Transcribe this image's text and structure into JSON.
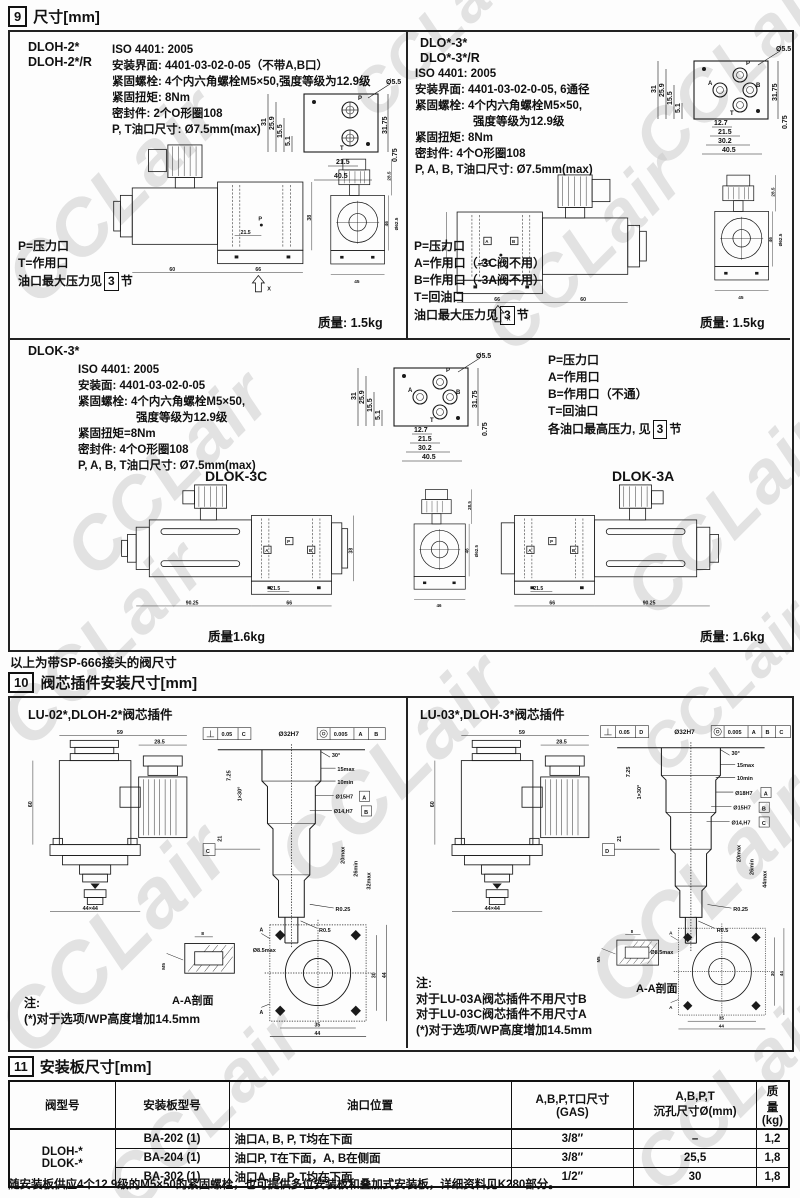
{
  "watermark": {
    "text": "CCLair"
  },
  "sec9": {
    "num": "9",
    "title": "尺寸[mm]",
    "dloh2": {
      "models": [
        "DLOH-2*",
        "DLOH-2*/R"
      ],
      "specs": [
        "ISO 4401: 2005",
        "安装界面: 4401-03-02-0-05（不带A,B口）",
        "紧固螺栓: 4个内六角螺栓M5×50,强度等级为12.9级",
        "紧固扭矩: 8Nm",
        "密封件: 2个O形圈108",
        "P, T油口尺寸: Ø7.5mm(max)"
      ],
      "ports": [
        "P=压力口",
        "T=作用口"
      ],
      "pnote": {
        "prefix": "油口最大压力见",
        "ref": "3",
        "suffix": "节"
      },
      "mass": "质量: 1.5kg",
      "face": {
        "callout": "Ø5.5",
        "p": "P",
        "t": "T",
        "l1": "31",
        "l2": "25.9",
        "l3": "15.5",
        "l4": "5.1",
        "b1": "21.5",
        "b2": "40.5",
        "r1": "31.75",
        "r2": "0.75"
      },
      "side": {
        "d1": "60",
        "d2": "66",
        "d3": "21.5",
        "d4": "38",
        "p": "P",
        "x": "X"
      },
      "end": {
        "d1": "28.5",
        "d2": "Ø62.5",
        "d3": "46",
        "d4": "45"
      }
    },
    "dlo3": {
      "models": [
        "DLO*-3*",
        "DLO*-3*/R"
      ],
      "specs": [
        "ISO 4401: 2005",
        "安装界面: 4401-03-02-0-05, 6通径",
        "紧固螺栓: 4个内六角螺栓M5×50,",
        "强度等级为12.9级",
        "紧固扭矩: 8Nm",
        "密封件: 4个O形圈108",
        "P, A, B, T油口尺寸: Ø7.5mm(max)"
      ],
      "ports": [
        "P=压力口",
        "A=作用口（-3C阀不用）",
        "B=作用口（-3A阀不用）",
        "T=回油口"
      ],
      "pnote": {
        "prefix": "油口最大压力见",
        "ref": "3",
        "suffix": "节"
      },
      "mass": "质量: 1.5kg",
      "face": {
        "callout": "Ø5.5",
        "p": "P",
        "a": "A",
        "b": "B",
        "t": "T",
        "l1": "31",
        "l2": "25.9",
        "l3": "15.5",
        "l4": "5.1",
        "b0": "12.7",
        "b1": "21.5",
        "b15": "30.2",
        "b2": "40.5",
        "r1": "31.75",
        "r2": "0.75"
      },
      "side": {
        "d1": "66",
        "d2": "60",
        "d3": "21.5",
        "d4": "38",
        "a": "A",
        "b": "B",
        "x": "X"
      },
      "end": {
        "d1": "28.5",
        "d2": "Ø62.5",
        "d3": "46",
        "d4": "45"
      }
    },
    "dlok3": {
      "model": "DLOK-3*",
      "specs": [
        "ISO 4401: 2005",
        "安装面: 4401-03-02-0-05",
        "紧固螺栓: 4个内六角螺栓M5×50,",
        "强度等级为12.9级",
        "紧固扭矩=8Nm",
        "密封件: 4个O形圈108",
        "P, A, B, T油口尺寸: Ø7.5mm(max)"
      ],
      "ports": [
        "P=压力口",
        "A=作用口",
        "B=作用口（不通）",
        "T=回油口"
      ],
      "pnote": {
        "prefix": "各油口最高压力, 见",
        "ref": "3",
        "suffix": "节"
      },
      "face": {
        "callout": "Ø5.5",
        "p": "P",
        "a": "A",
        "b": "B",
        "t": "T",
        "l1": "31",
        "l2": "25.9",
        "l3": "15.5",
        "l4": "5.1",
        "b0": "12.7",
        "b1": "21.5",
        "b15": "30.2",
        "b2": "40.5",
        "r1": "31.75",
        "r2": "0.75"
      },
      "c": {
        "title": "DLOK-3C",
        "mass": "质量1.6kg",
        "d1": "90.25",
        "d2": "66",
        "d3": "21.5",
        "d4": "38",
        "a": "A",
        "p": "P",
        "b": "B"
      },
      "a": {
        "title": "DLOK-3A",
        "mass": "质量: 1.6kg",
        "d1": "66",
        "d2": "90.25",
        "d3": "21.5",
        "a": "A",
        "p": "P",
        "b": "B"
      },
      "end": {
        "d1": "28.5",
        "d2": "Ø62.5",
        "d3": "46",
        "d4": "46"
      }
    },
    "sp_note": "以上为带SP-666接头的阀尺寸"
  },
  "sec10": {
    "num": "10",
    "title": "阀芯插件安装尺寸[mm]",
    "left": {
      "title": "LU-02*,DLOH-2*阀芯插件",
      "cart": {
        "d1": "59",
        "d2": "28.5",
        "d3": "60",
        "d4": "44×44"
      },
      "cavity": {
        "f1": "0.05",
        "f1d": "C",
        "bore": "Ø32H7",
        "f2": "0.005",
        "f2a": "A",
        "f2b": "B",
        "ang": "30°",
        "r1": "15max",
        "r2": "10min",
        "h1": "Ø15H7",
        "h1d": "A",
        "h2": "Ø14,H7",
        "h2d": "B",
        "l1": "7.25",
        "l2": "1×30°",
        "l3": "21",
        "s1": "20max",
        "s2": "26min",
        "s3": "32max",
        "rr1": "R0.25",
        "rr2": "R0.5",
        "bot": "Ø8.5max",
        "datum": "C"
      },
      "aa": {
        "w": "8",
        "m": "M5",
        "label": "A-A剖面"
      },
      "flange": {
        "a": "A",
        "r1": "30",
        "r2": "44",
        "b1": "35",
        "b2": "44"
      },
      "notes": [
        "注:",
        "(*)对于选项/WP高度增加14.5mm"
      ]
    },
    "right": {
      "title": "LU-03*,DLOH-3*阀芯插件",
      "cart": {
        "d1": "59",
        "d2": "28.5",
        "d3": "60",
        "d4": "44×44"
      },
      "cavity": {
        "f1": "0.05",
        "f1d": "D",
        "bore": "Ø32H7",
        "f2": "0.005",
        "f2a": "A",
        "f2b": "B",
        "f2c": "C",
        "ang": "30°",
        "r1": "15max",
        "r2": "10min",
        "h0": "Ø18H7",
        "h0d": "A",
        "h1": "Ø15H7",
        "h1d": "B",
        "h2": "Ø14,H7",
        "h2d": "C",
        "l1": "7.25",
        "l2": "1×30°",
        "l3": "21",
        "s1": "20max",
        "s2": "26min",
        "s3": "44max",
        "rr1": "R0.25",
        "rr2": "R0.5",
        "bot": "Ø8.5max",
        "datum": "D"
      },
      "aa": {
        "w": "8",
        "m": "M5",
        "label": "A-A剖面"
      },
      "flange": {
        "a": "A",
        "r1": "30",
        "r2": "44",
        "b1": "35",
        "b2": "44"
      },
      "notes": [
        "注:",
        "对于LU-03A阀芯插件不用尺寸B",
        "对于LU-03C阀芯插件不用尺寸A",
        "(*)对于选项/WP高度增加14.5mm"
      ]
    }
  },
  "sec11": {
    "num": "11",
    "title": "安装板尺寸[mm]",
    "table": {
      "h1": "阀型号",
      "h2": "安装板型号",
      "h3": "油口位置",
      "h4a": "A,B,P,T口尺寸",
      "h4b": "(GAS)",
      "h5a": "A,B,P,T",
      "h5b": "沉孔尺寸Ø(mm)",
      "h6a": "质量",
      "h6b": "(kg)",
      "models": [
        "DLOH-*",
        "DLOK-*"
      ],
      "rows": [
        {
          "board": "BA-202 (1)",
          "ports": "油口A, B, P, T均在下面",
          "size": "3/8″",
          "bore": "–",
          "mass": "1,2"
        },
        {
          "board": "BA-204 (1)",
          "ports": "油口P, T在下面，A, B在侧面",
          "size": "3/8″",
          "bore": "25,5",
          "mass": "1,8"
        },
        {
          "board": "BA-302 (1)",
          "ports": "油口A, B, P, T均在下面",
          "size": "1/2″",
          "bore": "30",
          "mass": "1,8"
        }
      ]
    },
    "footnote": "随安装板供应4个12.9级的M5×50的紧固螺栓，也可提供多位安装板和叠加式安装板，详细资料见K280部分。"
  }
}
